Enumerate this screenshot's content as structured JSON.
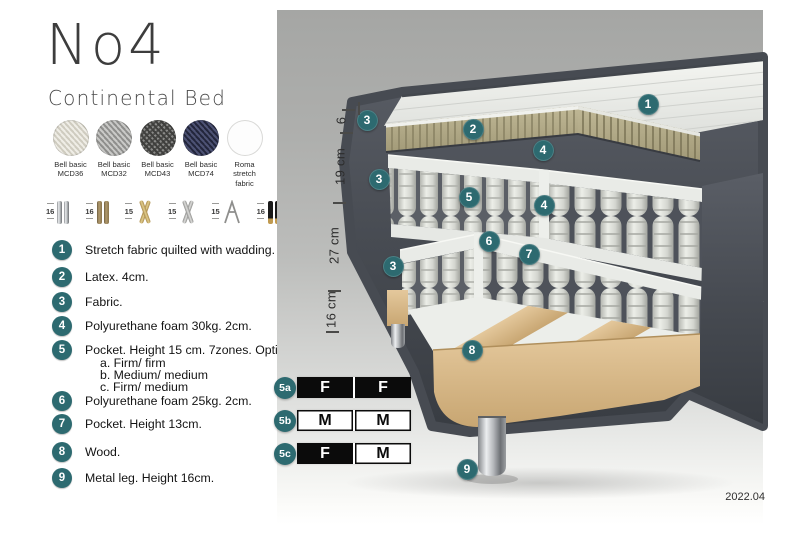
{
  "header": {
    "title": "No4",
    "subtitle": "Continental Bed"
  },
  "fabrics": [
    {
      "name": "Bell basic",
      "code": "MCD36"
    },
    {
      "name": "Bell basic",
      "code": "MCD32"
    },
    {
      "name": "Bell basic",
      "code": "MCD43"
    },
    {
      "name": "Bell basic",
      "code": "MCD74"
    },
    {
      "name": "Roma",
      "code": "stretch fabric"
    }
  ],
  "legs": [
    {
      "height": "16",
      "type": "cyl-chrome"
    },
    {
      "height": "16",
      "type": "cyl-bronze"
    },
    {
      "height": "15",
      "type": "cross-gold"
    },
    {
      "height": "15",
      "type": "cross-silver"
    },
    {
      "height": "15",
      "type": "hairpin"
    },
    {
      "height": "16",
      "type": "black-gold"
    }
  ],
  "features": [
    {
      "num": "1",
      "text": "Stretch fabric quilted with wadding.",
      "options": []
    },
    {
      "num": "2",
      "text": "Latex. 4cm.",
      "options": []
    },
    {
      "num": "3",
      "text": "Fabric.",
      "options": []
    },
    {
      "num": "4",
      "text": "Polyurethane foam 30kg. 2cm.",
      "options": []
    },
    {
      "num": "5",
      "text": "Pocket. Height 15 cm. 7zones. Option:",
      "options": [
        "a. Firm/ firm",
        "b. Medium/ medium",
        "c. Firm/ medium"
      ]
    },
    {
      "num": "6",
      "text": "Polyurethane foam 25kg. 2cm.",
      "options": []
    },
    {
      "num": "7",
      "text": "Pocket. Height 13cm.",
      "options": []
    },
    {
      "num": "8",
      "text": "Wood.",
      "options": []
    },
    {
      "num": "9",
      "text": "Metal leg. Height 16cm.",
      "options": []
    }
  ],
  "diagram": {
    "callouts": [
      "1",
      "2",
      "3",
      "3",
      "3",
      "4",
      "4",
      "5",
      "6",
      "7",
      "8",
      "9"
    ],
    "dimensions": [
      "6",
      "19 cm",
      "27 cm",
      "16 cm"
    ],
    "firmness": [
      {
        "id": "5a",
        "cells": [
          {
            "label": "F",
            "style": "dark"
          },
          {
            "label": "F",
            "style": "dark"
          }
        ]
      },
      {
        "id": "5b",
        "cells": [
          {
            "label": "M",
            "style": "light"
          },
          {
            "label": "M",
            "style": "light"
          }
        ]
      },
      {
        "id": "5c",
        "cells": [
          {
            "label": "F",
            "style": "dark"
          },
          {
            "label": "M",
            "style": "light"
          }
        ]
      }
    ],
    "version": "2022.04"
  },
  "colors": {
    "accent_teal": "#2d6a70",
    "firmness_black": "#0b0b0b",
    "panel_gray_top": "#a5a6a4",
    "upholstery_dark_gray": "#474b52",
    "latex_tan": "#b6ae8c",
    "wood": "#d9ba8b",
    "mattress_white": "#e9ebe7"
  }
}
